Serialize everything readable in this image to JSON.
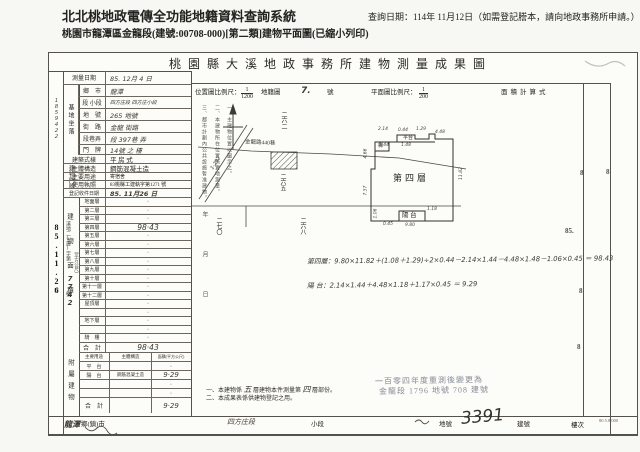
{
  "header": {
    "system_title": "北北桃地政電傳全功能地籍資料查詢系統",
    "query_date": "查詢日期：114年 11月12日（如需登記謄本，請向地政事務所申請。）",
    "subtitle": "桃園市龍潭區金龍段(建號:00708-000)[第二類]建物平面圖(已縮小列印)"
  },
  "sheet": {
    "title": "桃 園 縣 大 溪 地 政 事 務 所 建 物 測 量 成 果 圖",
    "scale_row": {
      "loc_label": "位置圖比例尺：",
      "loc_num": "1",
      "loc_den": "1200",
      "cad_label": "地籍圖",
      "cad_no": "7.",
      "cad_suffix": "號",
      "plan_label": "平面圖比例尺：",
      "plan_num": "1",
      "plan_den": "200",
      "area_calc_label": "面積計算式"
    }
  },
  "receipt_strip": {
    "serial": "1859422",
    "prefix": "溪地二(建)字第",
    "date_stamp": "85.11.26",
    "number": "7742",
    "date_char": "日",
    "no_char": "號"
  },
  "left_table": {
    "rows_top": [
      {
        "label": "測量日期",
        "value": "85. 12月 4 日",
        "hand": true
      },
      {
        "label": "鄉　市",
        "value": "龍潭",
        "hand": true
      },
      {
        "label": "段 小段",
        "value": "四方庄段 四方庄小段",
        "hand": true,
        "small": true
      },
      {
        "label": "地　號",
        "value": "265 地號",
        "hand": true
      },
      {
        "label": "街　路",
        "value": "金龍 街路",
        "hand": true
      },
      {
        "label": "段巷弄",
        "value": "段 397巷 弄",
        "hand": true
      },
      {
        "label": "門　牌",
        "value": "14號 之 樓",
        "hand": true
      },
      {
        "label": "建築式樣",
        "value": "平 房 式"
      },
      {
        "label": "主體構造",
        "value": "鋼筋混凝土造"
      },
      {
        "label": "主要用途",
        "value": "寄宿舍",
        "small": true
      },
      {
        "label": "使用執照",
        "value": "83桃縣工建執字第1271 號",
        "small": true
      },
      {
        "label": "登記收件日期",
        "value": "85. 11月26 日",
        "stamp": true
      }
    ],
    "site_group": "基地坐落",
    "door_group": "建物門牌",
    "area_group": "建物面積",
    "area_unit": "（平方公尺）",
    "floor_rows": [
      {
        "label": "地面層",
        "value": "·"
      },
      {
        "label": "第二層",
        "value": "·"
      },
      {
        "label": "第三層",
        "value": "·"
      },
      {
        "label": "第四層",
        "value": "98·43",
        "hand": true
      },
      {
        "label": "第五層",
        "value": "·"
      },
      {
        "label": "第六層",
        "value": "·"
      },
      {
        "label": "第七層",
        "value": "·"
      },
      {
        "label": "第八層",
        "value": "·"
      },
      {
        "label": "第九層",
        "value": "·"
      },
      {
        "label": "第十層",
        "value": "·"
      },
      {
        "label": "第十一層",
        "value": "·"
      },
      {
        "label": "第十二層",
        "value": "·"
      },
      {
        "label": "屋頂層",
        "value": "·"
      },
      {
        "label": "",
        "value": "·"
      },
      {
        "label": "地下層",
        "value": "·"
      },
      {
        "label": "",
        "value": "·"
      },
      {
        "label": "騎　樓",
        "value": "·"
      }
    ],
    "total_row": {
      "label": "合　計",
      "value": "98·43"
    },
    "annex_group": "附屬建物",
    "annex_header": [
      "主要用途",
      "主體構造",
      "面積(平方公尺)"
    ],
    "annex_rows": [
      {
        "use": "平　台",
        "structure": "",
        "area": "·"
      },
      {
        "use": "陽　台",
        "structure": "鋼筋混凝土造",
        "area": "9·29",
        "hand": true
      },
      {
        "use": "",
        "structure": "",
        "area": "·"
      },
      {
        "use": "",
        "structure": "",
        "area": "·"
      }
    ],
    "annex_total": {
      "label": "合　計",
      "value": "9·29"
    }
  },
  "location_map": {
    "diag_road_label": "1-292",
    "road_label": "金龍路440巷",
    "parcel_top": "二六二",
    "parcel_mid": "二六五",
    "parcel_bottom_right": "二六八",
    "parcel_bottom_left": "二七〇"
  },
  "plan": {
    "floor_label": "第四層",
    "balcony_label": "陽 台",
    "stair_label": "梯",
    "terrace_label": "平台",
    "dims": [
      {
        "t": "2.14",
        "x": 329,
        "y": 74
      },
      {
        "t": "0.44",
        "x": 349,
        "y": 75
      },
      {
        "t": "1.29",
        "x": 367,
        "y": 74
      },
      {
        "t": "4.48",
        "x": 386,
        "y": 77
      },
      {
        "t": "1.44",
        "x": 330,
        "y": 90
      },
      {
        "t": "1.48",
        "x": 352,
        "y": 90
      },
      {
        "t": "4.66",
        "x": 312,
        "y": 98,
        "v": 1
      },
      {
        "t": "7.57",
        "x": 312,
        "y": 135,
        "v": 1
      },
      {
        "t": "11.82",
        "x": 406,
        "y": 118,
        "v": 1
      },
      {
        "t": "1.06",
        "x": 322,
        "y": 158,
        "v": 1
      },
      {
        "t": "0.45",
        "x": 334,
        "y": 169
      },
      {
        "t": "1.18",
        "x": 378,
        "y": 154
      },
      {
        "t": "9.80",
        "x": 356,
        "y": 170
      }
    ]
  },
  "calculations": {
    "line1": "第四層：9.80×11.82＋(1.08＋1.29)÷2×0.44－2.14×1.44－4.48×1.48－1.06×0.45 ＝ 98.43",
    "line2": "陽 台：2.14×1.44＋4.48×1.18＋1.17×0.45 ＝ 9.29"
  },
  "stamp": {
    "line1": "一百零四年度重測後變更為",
    "line2": "金龍段 1796 地號 708 建號"
  },
  "notes_vertical": [
    "一、主建物位置以圖示之。",
    "二、本建物所在位置係實地測量。",
    "三、都市計劃內公共設施暫准建物。"
  ],
  "date_blank": "年　月　日",
  "legend": {
    "line1_pre": "一、本建物係",
    "line1_hand1": "五",
    "line1_mid": "層建物本件測量第",
    "line1_hand2": "四",
    "line1_post": "層部份。",
    "line2": "二、本成果表係供建物登記之用。"
  },
  "bottom_strip": {
    "hand_town": "龍潭",
    "town_label": "鄉(鎮)市",
    "hand_section": "四方庄段",
    "subsection_label": "小段",
    "parcel_label": "地號",
    "hand_building_no": "3391",
    "building_label": "建號",
    "floor_label": "樓次",
    "form_code": "80.5.8.000"
  },
  "margin_marks": [
    {
      "t": "8",
      "x": 531,
      "y": 116
    },
    {
      "t": "8",
      "x": 557,
      "y": 115
    },
    {
      "t": "85.",
      "x": 516,
      "y": 174
    },
    {
      "t": "8",
      "x": 530,
      "y": 234
    },
    {
      "t": "8",
      "x": 528,
      "y": 290
    }
  ]
}
